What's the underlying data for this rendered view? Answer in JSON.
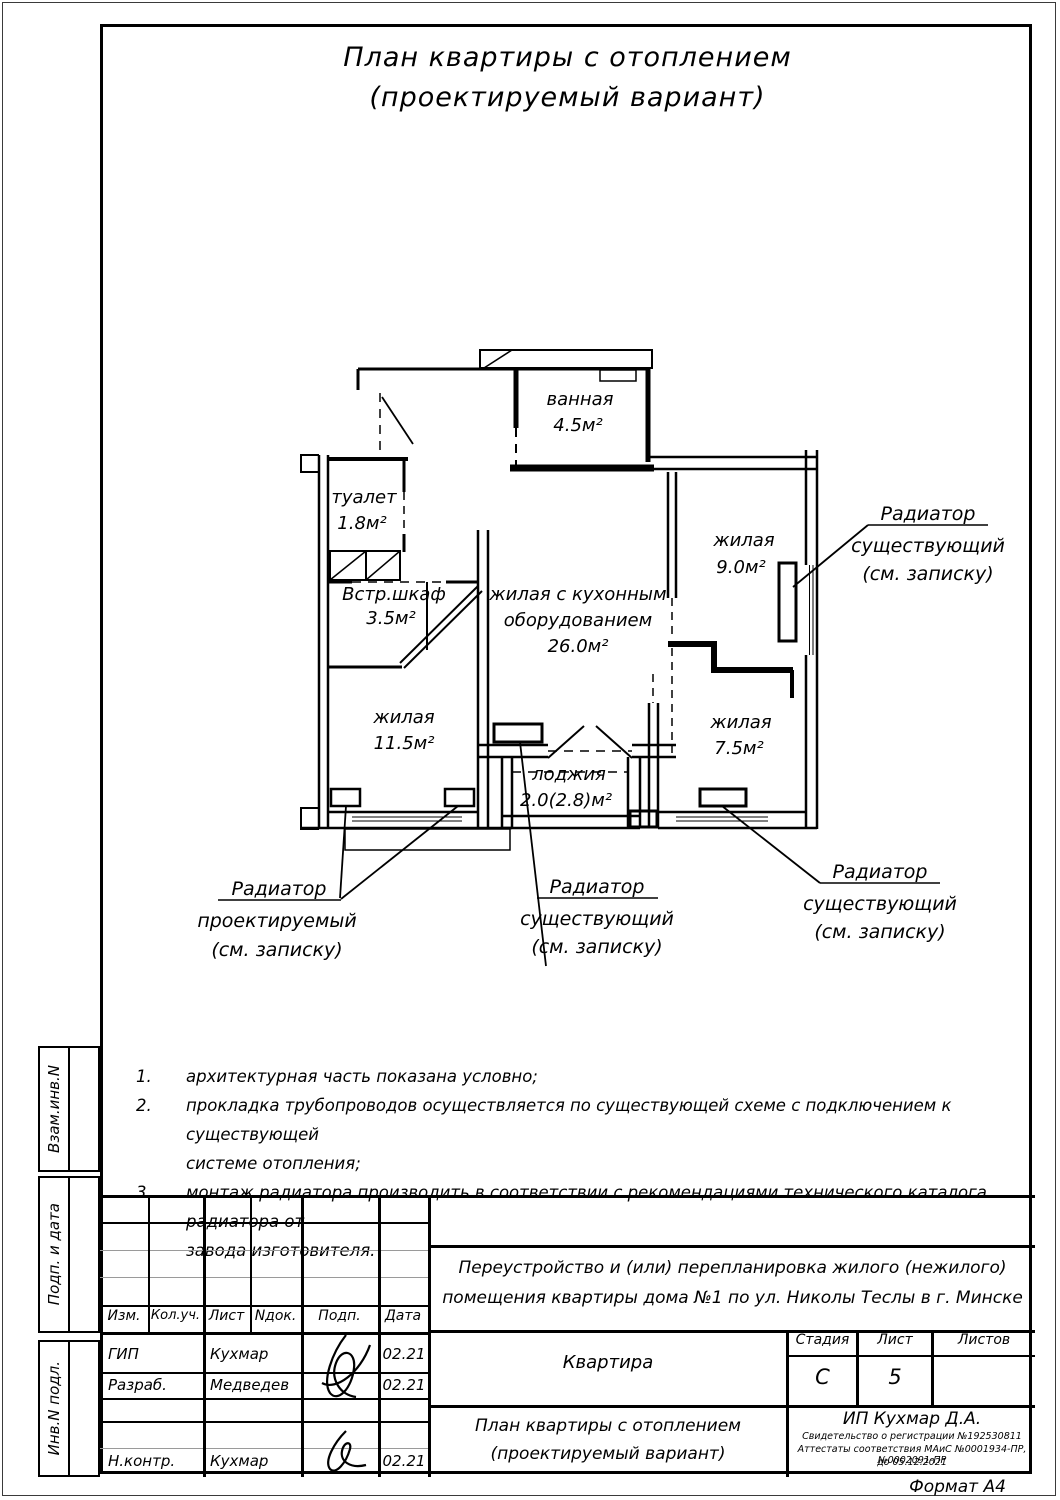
{
  "page": {
    "title_line1": "План квартиры с отоплением",
    "title_line2": "(проектируемый вариант)",
    "format_label": "Формат А4"
  },
  "sidebar": {
    "box1": "Взам.инв.N",
    "box2": "Подп. и дата",
    "box3": "Инв.N подл."
  },
  "plan": {
    "rooms": {
      "bath": {
        "name": "ванная",
        "area": "4.5м²"
      },
      "toilet": {
        "name": "туалет",
        "area": "1.8м²"
      },
      "closet": {
        "name": "Встр.шкаф",
        "area": "3.5м²"
      },
      "living1": {
        "name": "жилая",
        "area": "11.5м²"
      },
      "kitchen": {
        "name1": "жилая с кухонным",
        "name2": "оборудованием",
        "area": "26.0м²"
      },
      "living2": {
        "name": "жилая",
        "area": "9.0м²"
      },
      "living3": {
        "name": "жилая",
        "area": "7.5м²"
      },
      "loggia": {
        "name": "лоджия",
        "area": "2.0(2.8)м²"
      }
    },
    "callouts": {
      "top_right": {
        "line1": "Радиатор",
        "line2": "существующий",
        "line3": "(см. записку)"
      },
      "bottom_left": {
        "line1": "Радиатор",
        "line2": "проектируемый",
        "line3": "(см. записку)"
      },
      "bottom_center": {
        "line1": "Радиатор",
        "line2": "существующий",
        "line3": "(см. записку)"
      },
      "bottom_right": {
        "line1": "Радиатор",
        "line2": "существующий",
        "line3": "(см. записку)"
      }
    }
  },
  "notes": {
    "items": [
      {
        "num": "1.",
        "line1": "архитектурная часть показана условно;",
        "line2": ""
      },
      {
        "num": "2.",
        "line1": "прокладка трубопроводов осуществляется по существующей схеме с подключением к существующей",
        "line2": "системе отопления;"
      },
      {
        "num": "3.",
        "line1": "монтаж радиатора производить в соответствии с рекомендациями технического каталога радиатора от",
        "line2": "завода изготовителя."
      }
    ]
  },
  "titleblock": {
    "col_izm": "Изм.",
    "col_koluch": "Кол.уч.",
    "col_list": "Лист",
    "col_ndok": "Nдок.",
    "col_podp": "Подп.",
    "col_data": "Дата",
    "project_line1": "Переустройство и (или) перепланировка жилого (нежилого)",
    "project_line2": "помещения квартиры дома №1 по ул. Николы Теслы в г. Минске",
    "object_name": "Квартира",
    "stage_label": "Стадия",
    "sheet_label": "Лист",
    "sheets_label": "Листов",
    "stage_value": "С",
    "sheet_value": "5",
    "sheets_value": "",
    "doc_title_line1": "План квартиры с отоплением",
    "doc_title_line2": "(проектируемый вариант)",
    "company": "ИП Кухмар Д.А.",
    "cert_line1": "Свидетельство о регистрации №192530811",
    "cert_line2": "Аттестаты соответствия МАиС №0001934-ПР, №0002091-ПР",
    "cert_line3": "до 05.12.2021",
    "rows": [
      {
        "role": "ГИП",
        "name": "Кухмар",
        "date": "02.21"
      },
      {
        "role": "Разраб.",
        "name": "Медведев",
        "date": "02.21"
      },
      {
        "role": "",
        "name": "",
        "date": ""
      },
      {
        "role": "",
        "name": "",
        "date": ""
      },
      {
        "role": "Н.контр.",
        "name": "Кухмар",
        "date": "02.21"
      }
    ]
  }
}
